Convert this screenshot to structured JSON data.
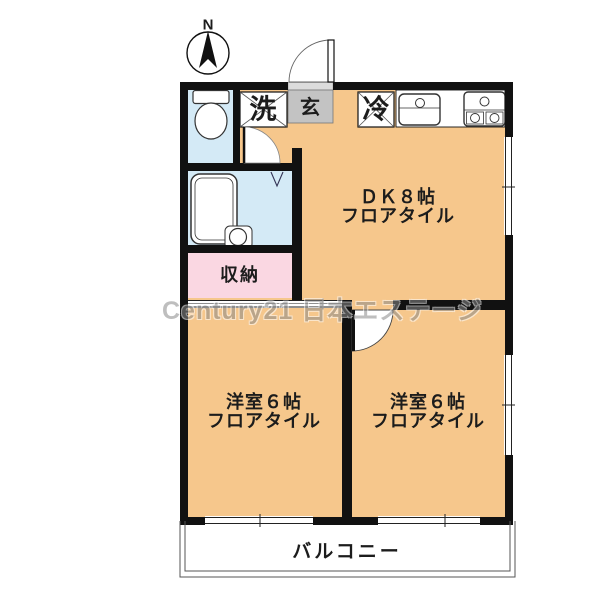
{
  "plan_labels": {
    "north": "N",
    "washer": "洗",
    "entrance": "玄",
    "fridge": "冷",
    "dk": {
      "line1": "ＤＫ８帖",
      "line2": "フロアタイル"
    },
    "storage": "収納",
    "room_left": {
      "line1": "洋室６帖",
      "line2": "フロアタイル"
    },
    "room_right": {
      "line1": "洋室６帖",
      "line2": "フロアタイル"
    },
    "balcony": "バルコニー",
    "watermark": "Century21 日本エステージ"
  },
  "colors": {
    "floor": "#f6c78c",
    "wet_area": "#d4eaf6",
    "storage": "#fad7e2",
    "entrance": "#c3c3c3",
    "wall": "#111111",
    "watermark": "#8a8a8a"
  }
}
